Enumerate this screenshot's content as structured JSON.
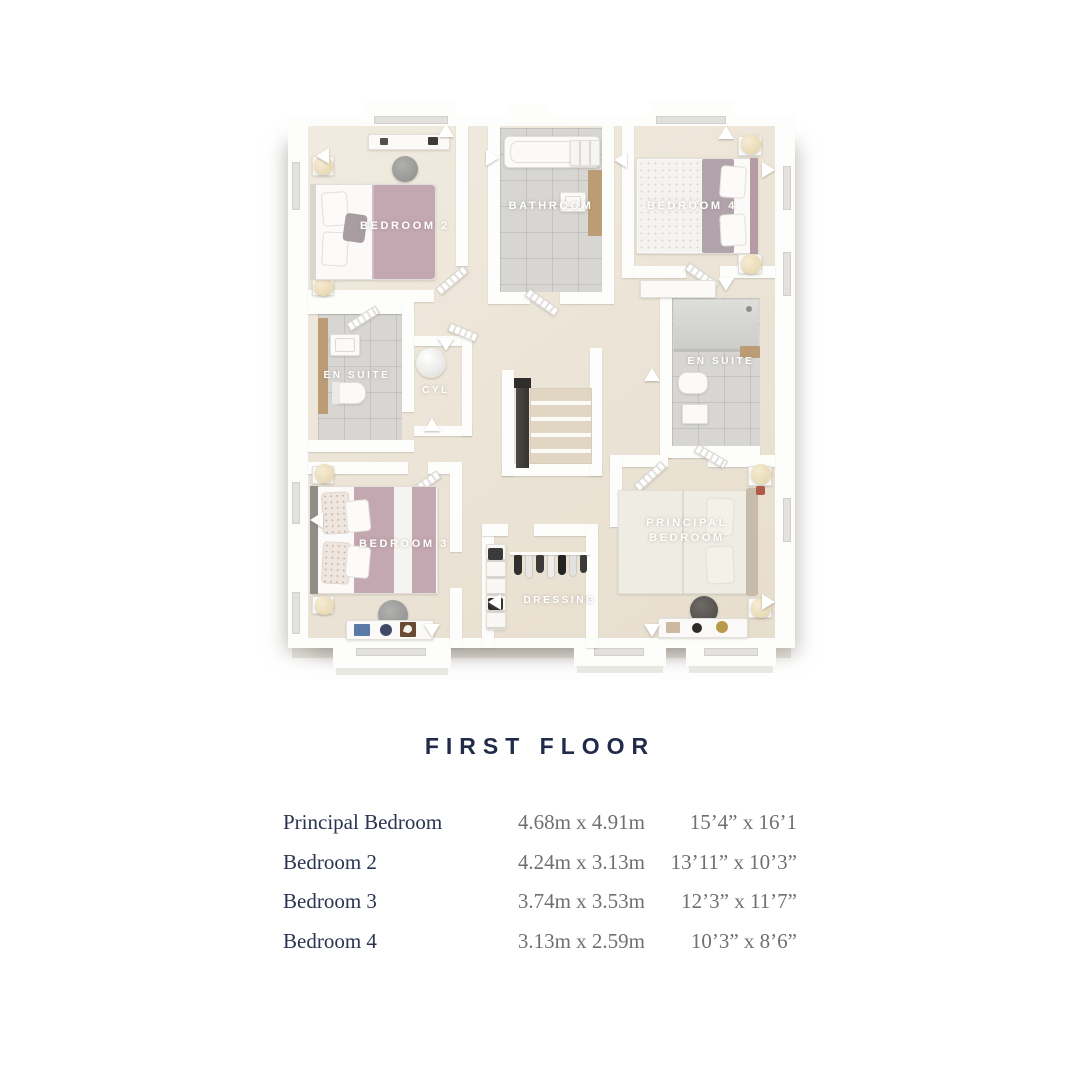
{
  "title": "FIRST FLOOR",
  "plan": {
    "labels": {
      "bedroom2": "BEDROOM 2",
      "bathroom": "BATHROOM",
      "bedroom4": "BEDROOM 4",
      "ensuite_left": "EN SUITE",
      "cyl": "CYL",
      "ensuite_right": "EN SUITE",
      "bedroom3": "BEDROOM 3",
      "dressing": "DRESSING",
      "principal": "PRINCIPAL BEDROOM"
    },
    "colors": {
      "floor": "#ece4d5",
      "tile": "#d7d6d2",
      "wall": "#fdfdfc",
      "duvet_mauve": "#c3a7b1",
      "headboard_taupe": "#c7bcab",
      "stair_rail": "#3a3936",
      "lamp_cream": "#ecdcb4",
      "wood": "#bb9c75"
    }
  },
  "dimensions": {
    "rows": [
      {
        "name": "Principal Bedroom",
        "metric": "4.68m x 4.91m",
        "imperial": "15’4” x 16’1"
      },
      {
        "name": "Bedroom 2",
        "metric": "4.24m x 3.13m",
        "imperial": "13’11” x 10’3”"
      },
      {
        "name": "Bedroom 3",
        "metric": "3.74m x 3.53m",
        "imperial": "12’3” x 11’7”"
      },
      {
        "name": "Bedroom 4",
        "metric": "3.13m x 2.59m",
        "imperial": "10’3” x 8’6”"
      }
    ]
  },
  "text_colors": {
    "heading_navy": "#212b49",
    "table_navy": "#2a3350",
    "dim_gray": "#707070"
  }
}
